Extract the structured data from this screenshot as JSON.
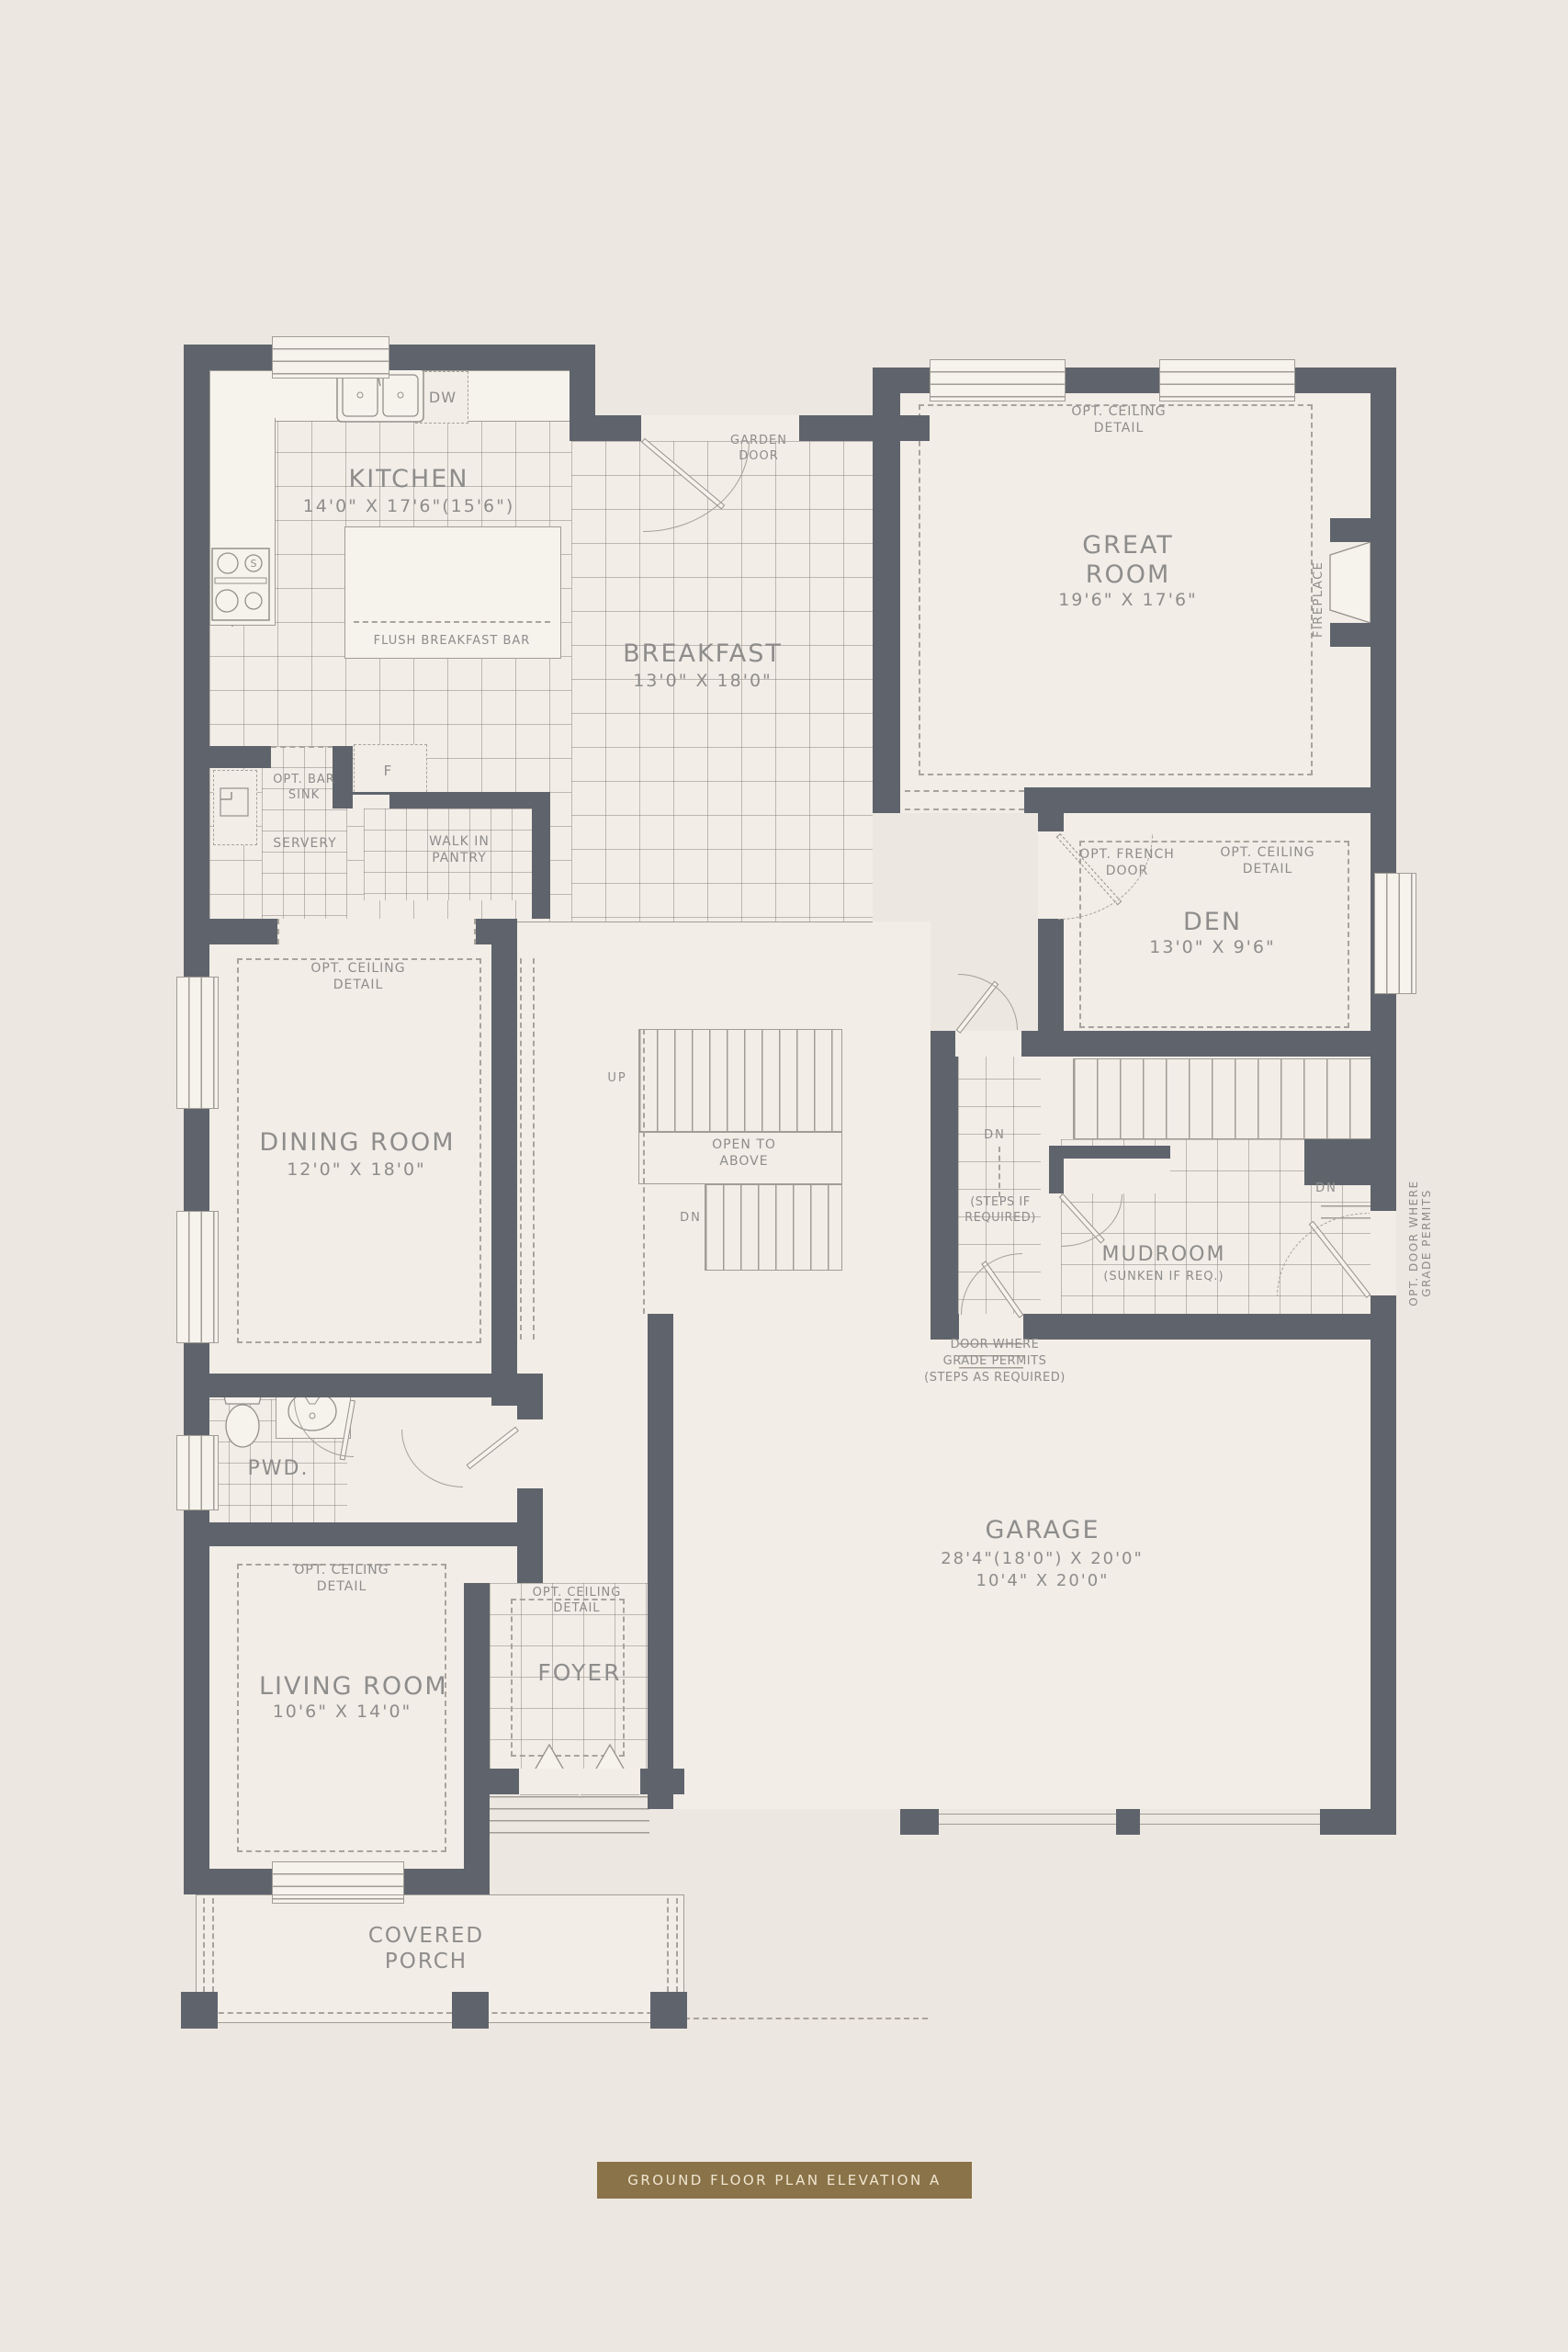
{
  "colors": {
    "wall": "#5f646c",
    "background": "#ece7e0",
    "floor": "#f2ede7",
    "text": "#8e8d8c",
    "accent_banner": "#8a7348",
    "banner_text": "#f0e6d2"
  },
  "banner": {
    "label": "GROUND FLOOR PLAN ELEVATION A"
  },
  "rooms": {
    "kitchen": {
      "name": "KITCHEN",
      "dims": "14'0\" X 17'6\"(15'6\")"
    },
    "breakfast": {
      "name": "BREAKFAST",
      "dims": "13'0\" X 18'0\""
    },
    "great_room": {
      "name_1": "GREAT",
      "name_2": "ROOM",
      "dims": "19'6\" X 17'6\""
    },
    "den": {
      "name": "DEN",
      "dims": "13'0\" X 9'6\""
    },
    "dining": {
      "name": "DINING ROOM",
      "dims": "12'0\" X 18'0\""
    },
    "living": {
      "name": "LIVING ROOM",
      "dims": "10'6\" X 14'0\""
    },
    "garage": {
      "name": "GARAGE",
      "dims_1": "28'4\"(18'0\") X 20'0\"",
      "dims_2": "10'4\" X 20'0\""
    },
    "mudroom": {
      "name": "MUDROOM",
      "note": "(SUNKEN IF REQ.)"
    },
    "foyer": {
      "name": "FOYER"
    },
    "pwd": {
      "name": "PWD."
    },
    "servery": {
      "name": "SERVERY"
    },
    "pantry": {
      "name_1": "WALK IN",
      "name_2": "PANTRY"
    },
    "porch": {
      "name_1": "COVERED",
      "name_2": "PORCH"
    }
  },
  "annotations": {
    "opt_ceiling_1": "OPT. CEILING",
    "opt_ceiling_2": "DETAIL",
    "garden_1": "GARDEN",
    "garden_2": "DOOR",
    "bar_sink_1": "OPT. BAR",
    "bar_sink_2": "SINK",
    "fridge": "F",
    "dw": "DW",
    "flush_bar": "FLUSH BREAKFAST BAR",
    "french_1": "OPT. FRENCH",
    "french_2": "DOOR",
    "fireplace": "FIREPLACE",
    "open_above_1": "OPEN TO",
    "open_above_2": "ABOVE",
    "up": "UP",
    "dn": "DN",
    "steps_if_1": "(STEPS IF",
    "steps_if_2": "REQUIRED)",
    "door_grade_1": "DOOR WHERE",
    "door_grade_2": "GRADE PERMITS",
    "door_grade_3": "(STEPS AS REQUIRED)",
    "opt_door_grade_1": "OPT. DOOR WHERE",
    "opt_door_grade_2": "GRADE PERMITS"
  }
}
